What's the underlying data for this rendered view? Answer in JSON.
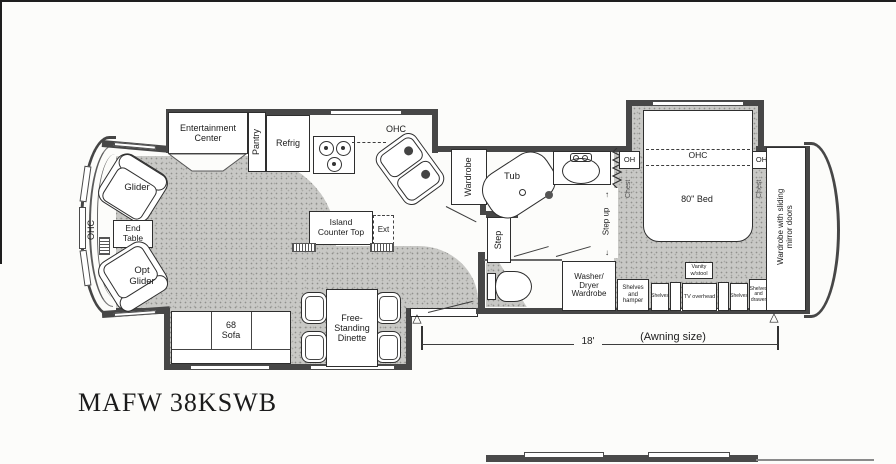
{
  "title": "MAFW 38KSWB",
  "front": {
    "ohc": "OHC",
    "glider": "Glider",
    "end_table": "End\nTable",
    "opt_glider": "Opt\nGlider"
  },
  "kitchen": {
    "entertainment_center": "Entertainment\nCenter",
    "pantry": "Pantry",
    "refrig": "Refrig",
    "ohc": "OHC",
    "island_counter": "Island\nCounter Top",
    "ext": "Ext"
  },
  "galley": {
    "wardrobe": "Wardrobe",
    "step": "Step"
  },
  "living": {
    "sofa": "68\nSofa",
    "dinette": "Free-\nStanding\nDinette"
  },
  "bath": {
    "tub": "Tub",
    "step_up": "Step up",
    "arrow_up": "↑",
    "arrow_down": "↓",
    "washer_dryer": "Washer/\nDryer\nWardrobe"
  },
  "bedroom": {
    "oh_left": "OH",
    "oh_right": "OH",
    "chest_left": "Chest",
    "chest_right": "Chest",
    "ohc": "OHC",
    "bed": "80\" Bed",
    "vanity": "Vanity\nw/stool",
    "shelves_hamper": "Shelves\nand\nhamper",
    "shelves_a": "Shelves",
    "tv_overhead": "TV overhead",
    "shelves_b": "Shelves",
    "shelves_drawer": "Shelves\nand\ndrawer",
    "wardrobe_mirror": "Wardrobe with sliding\nmirror doors"
  },
  "dimension": {
    "length": "18'",
    "label": "(Awning size)"
  },
  "colors": {
    "wall": "#474747",
    "floor_speckle": "#c8c8c5",
    "ink": "#1c1c1c"
  }
}
